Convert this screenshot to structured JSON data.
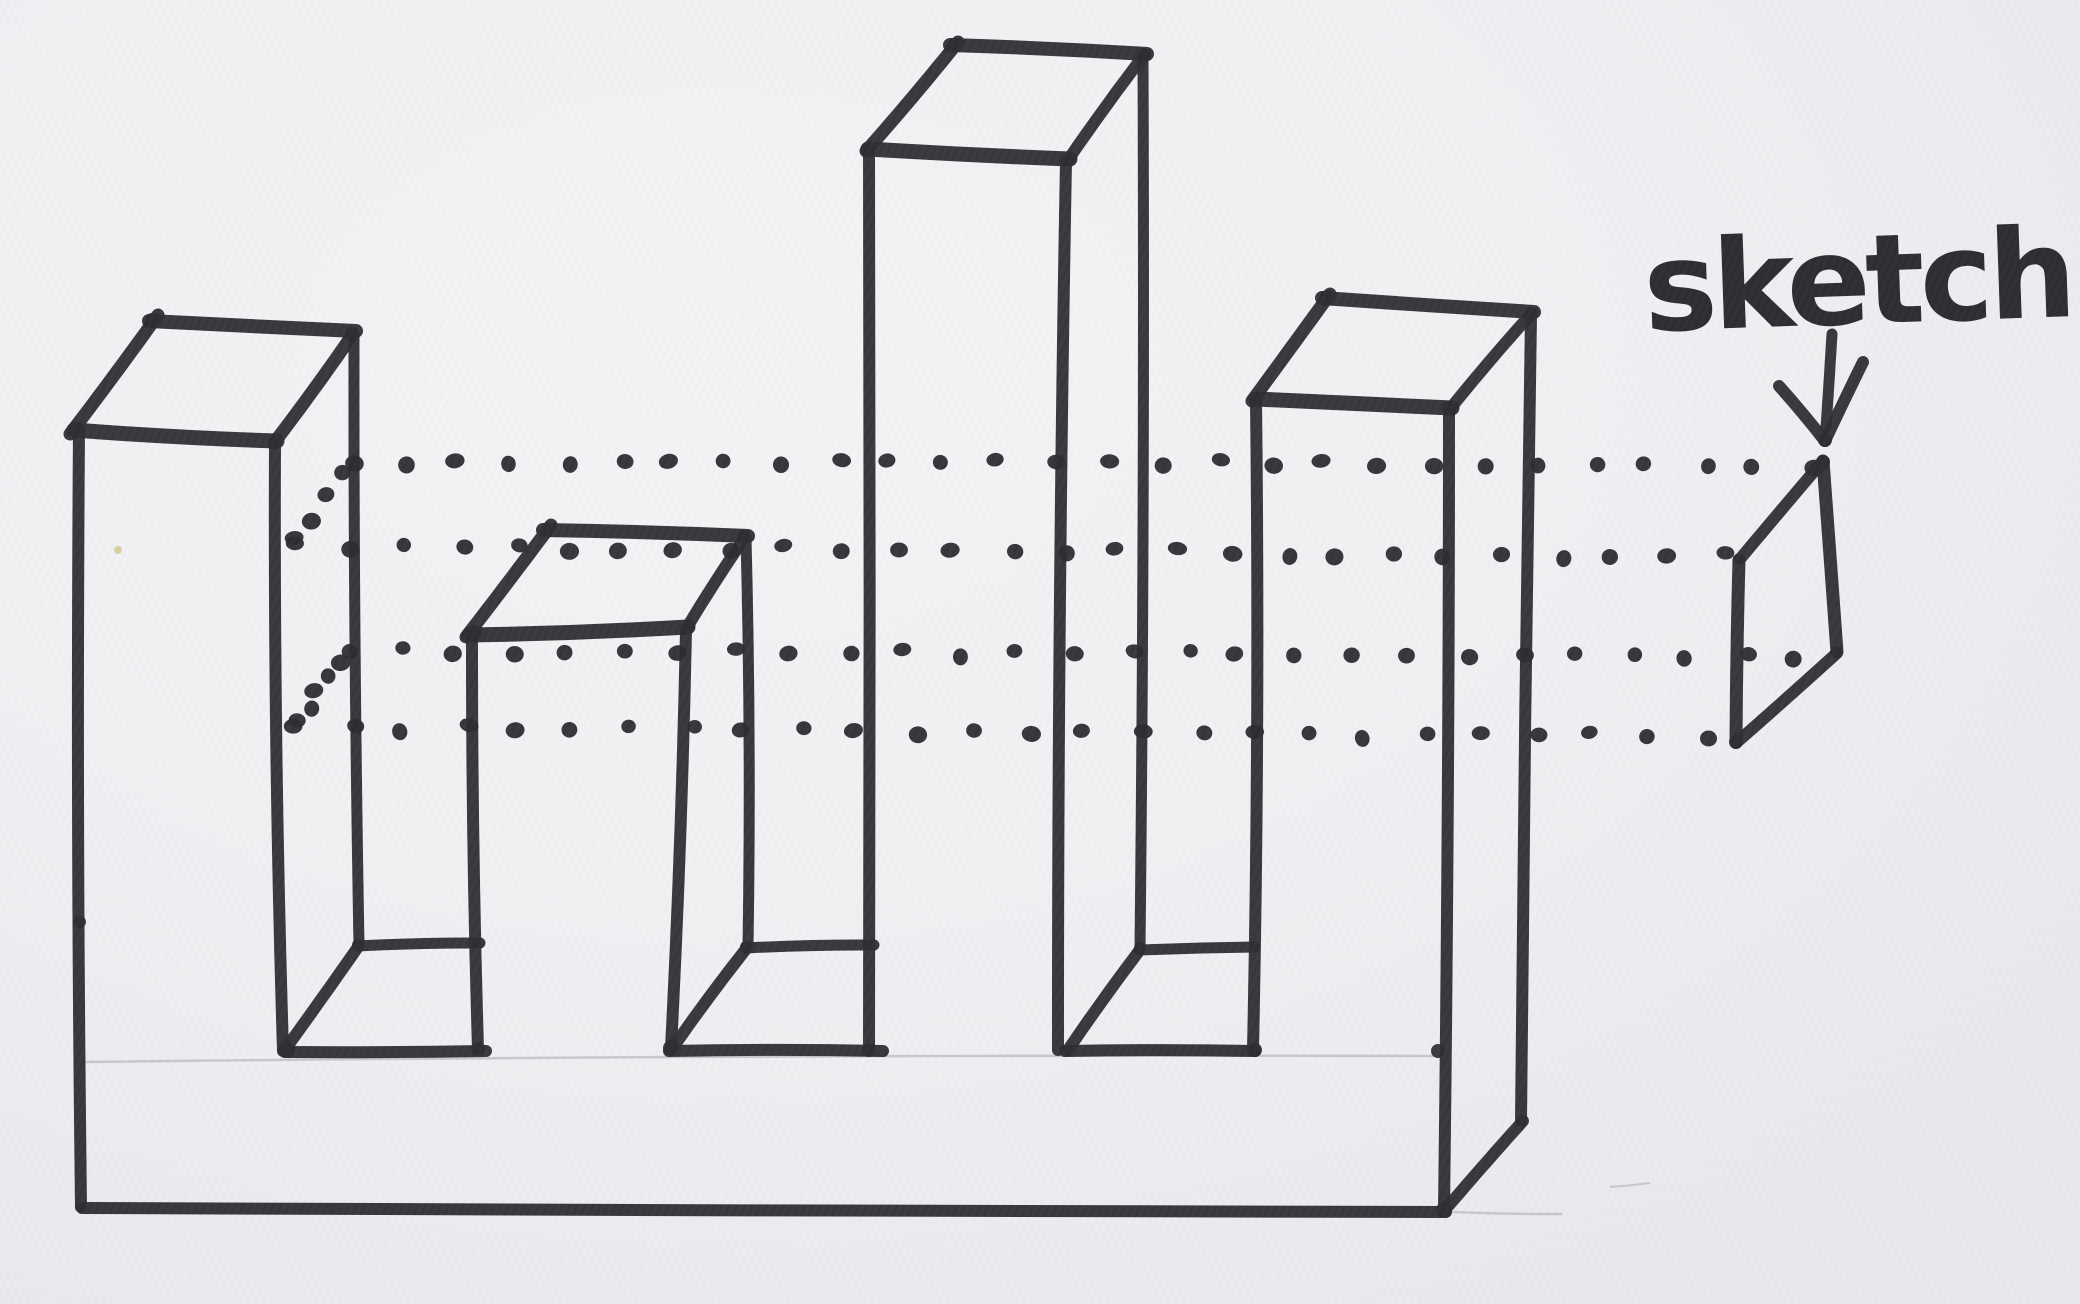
{
  "label": {
    "text": "sketch"
  },
  "colors": {
    "ink": "#2d2c30",
    "dot_ink": "#2b2a2e",
    "pencil": "#c7c5c9",
    "paper": "#f0eff2",
    "speck": "#d8cf9e"
  },
  "diagram": {
    "solid": {
      "tower-1": [
        [
          "top-left-edge",
          70,
          434,
          158,
          315,
          13
        ],
        [
          "top-back-edge",
          149,
          321,
          356,
          331,
          14
        ],
        [
          "top-front-edge",
          74,
          430,
          277,
          441,
          15
        ],
        [
          "top-right-edge",
          274,
          443,
          353,
          334,
          13
        ],
        [
          "outer-left-edge",
          79,
          428,
          81,
          1207,
          12
        ],
        [
          "front-right-edge",
          275,
          442,
          283,
          1051,
          12
        ],
        [
          "back-right-edge",
          354,
          335,
          359,
          945,
          11
        ]
      ],
      "tower-2": [
        [
          "top-left-edge",
          466,
          637,
          551,
          525,
          13
        ],
        [
          "top-back-edge",
          543,
          530,
          748,
          536,
          14
        ],
        [
          "top-front-edge",
          469,
          635,
          688,
          627,
          15
        ],
        [
          "top-right-edge",
          686,
          629,
          745,
          537,
          12
        ],
        [
          "front-left-edge",
          472,
          634,
          478,
          1049,
          12
        ],
        [
          "front-right-edge",
          686,
          630,
          671,
          1048,
          12
        ],
        [
          "back-right-edge",
          746,
          538,
          748,
          946,
          11
        ]
      ],
      "tower-3": [
        [
          "top-left-edge",
          866,
          151,
          958,
          42,
          13
        ],
        [
          "top-back-edge",
          950,
          45,
          1147,
          54,
          14
        ],
        [
          "top-front-edge",
          868,
          149,
          1070,
          159,
          15
        ],
        [
          "top-right-edge",
          1068,
          160,
          1144,
          55,
          12
        ],
        [
          "front-left-edge",
          869,
          150,
          869,
          1050,
          12
        ],
        [
          "front-right-edge",
          1066,
          161,
          1058,
          1050,
          12
        ],
        [
          "back-right-edge",
          1143,
          56,
          1140,
          948,
          11
        ]
      ],
      "tower-4": [
        [
          "top-left-edge",
          1252,
          401,
          1330,
          294,
          13
        ],
        [
          "top-back-edge",
          1322,
          298,
          1534,
          312,
          14
        ],
        [
          "top-front-edge",
          1256,
          399,
          1452,
          408,
          15
        ],
        [
          "top-right-edge",
          1450,
          409,
          1531,
          314,
          12
        ],
        [
          "front-left-edge",
          1256,
          400,
          1253,
          1050,
          12
        ],
        [
          "front-right-edge",
          1449,
          410,
          1444,
          1210,
          12
        ],
        [
          "back-right-edge",
          1531,
          315,
          1521,
          1121,
          12
        ]
      ],
      "notch-1": [
        [
          "floor-back-edge",
          358,
          946,
          480,
          943,
          11
        ],
        [
          "floor-left-edge",
          358,
          947,
          284,
          1051,
          12
        ],
        [
          "floor-front-edge",
          285,
          1052,
          486,
          1051,
          12
        ]
      ],
      "notch-2": [
        [
          "floor-back-edge",
          746,
          948,
          874,
          945,
          11
        ],
        [
          "floor-left-edge",
          746,
          949,
          672,
          1049,
          12
        ],
        [
          "floor-front-edge",
          669,
          1051,
          883,
          1051,
          12
        ]
      ],
      "notch-3": [
        [
          "floor-back-edge",
          1139,
          950,
          1255,
          947,
          11
        ],
        [
          "floor-left-edge",
          1139,
          951,
          1068,
          1050,
          12
        ],
        [
          "floor-front-edge",
          1065,
          1051,
          1255,
          1051,
          12
        ]
      ],
      "base": [
        [
          "bottom-front-edge",
          82,
          1208,
          1446,
          1212,
          12
        ],
        [
          "bottom-right-edge",
          1444,
          1211,
          1523,
          1121,
          12
        ]
      ]
    },
    "profile": [
      [
        "top-depth-edge",
        1822,
        462,
        1740,
        559,
        12
      ],
      [
        "right-edge",
        1823,
        461,
        1837,
        652,
        13
      ],
      [
        "left-edge",
        1739,
        560,
        1736,
        742,
        13
      ],
      [
        "bottom-depth-edge",
        1736,
        743,
        1837,
        653,
        12
      ]
    ],
    "arrow": [
      [
        "arrow-shaft",
        1832,
        334,
        1826,
        428,
        11
      ],
      [
        "arrow-head-left-wing",
        1779,
        386,
        1825,
        441,
        12
      ],
      [
        "arrow-head-right-wing",
        1863,
        362,
        1825,
        441,
        12
      ]
    ],
    "pencil": [
      [
        "base-top-guideline",
        83,
        1062,
        1437,
        1056,
        2.5
      ],
      [
        "bottom-right-guideline",
        1450,
        1212,
        1562,
        1214,
        2.5
      ],
      [
        "stray-mark",
        1610,
        1187,
        1650,
        1183,
        2
      ]
    ],
    "dotted_rows": [
      {
        "name": "projection-row-back-top",
        "x1": 350,
        "y1": 461,
        "x2": 1812,
        "y2": 465,
        "count": 28
      },
      {
        "name": "projection-row-front-top",
        "x1": 294,
        "y1": 546,
        "x2": 1724,
        "y2": 556,
        "count": 27
      },
      {
        "name": "projection-row-back-bottom",
        "x1": 346,
        "y1": 651,
        "x2": 1800,
        "y2": 656,
        "count": 27
      },
      {
        "name": "projection-row-front-bottom",
        "x1": 293,
        "y1": 727,
        "x2": 1708,
        "y2": 737,
        "count": 26
      },
      {
        "name": "section-top-depth-dots",
        "x1": 349,
        "y1": 472,
        "x2": 298,
        "y2": 541,
        "count": 4
      },
      {
        "name": "section-bottom-depth-dots",
        "x1": 343,
        "y1": 660,
        "x2": 296,
        "y2": 722,
        "count": 5
      }
    ],
    "blobs": [
      [
        287,
        1050,
        8
      ],
      [
        671,
        1048,
        8
      ],
      [
        478,
        1049,
        7
      ],
      [
        1444,
        1210,
        8
      ],
      [
        80,
        922,
        6
      ],
      [
        1438,
        1051,
        7
      ],
      [
        358,
        945,
        6
      ],
      [
        746,
        947,
        6
      ],
      [
        474,
        633,
        8
      ],
      [
        1255,
        1050,
        7
      ],
      [
        869,
        1050,
        7
      ],
      [
        1140,
        948,
        6
      ],
      [
        1823,
        462,
        7
      ],
      [
        1736,
        742,
        7
      ],
      [
        152,
        320,
        7
      ],
      [
        1449,
        408,
        7
      ],
      [
        352,
        334,
        7
      ],
      [
        744,
        537,
        7
      ],
      [
        1144,
        55,
        7
      ],
      [
        1531,
        314,
        7
      ],
      [
        1825,
        440,
        7
      ],
      [
        955,
        45,
        7
      ],
      [
        1327,
        297,
        7
      ]
    ],
    "speck": [
      118,
      550,
      4
    ],
    "label_pos": {
      "x": 1645,
      "y": 331,
      "rotate": -2
    }
  }
}
